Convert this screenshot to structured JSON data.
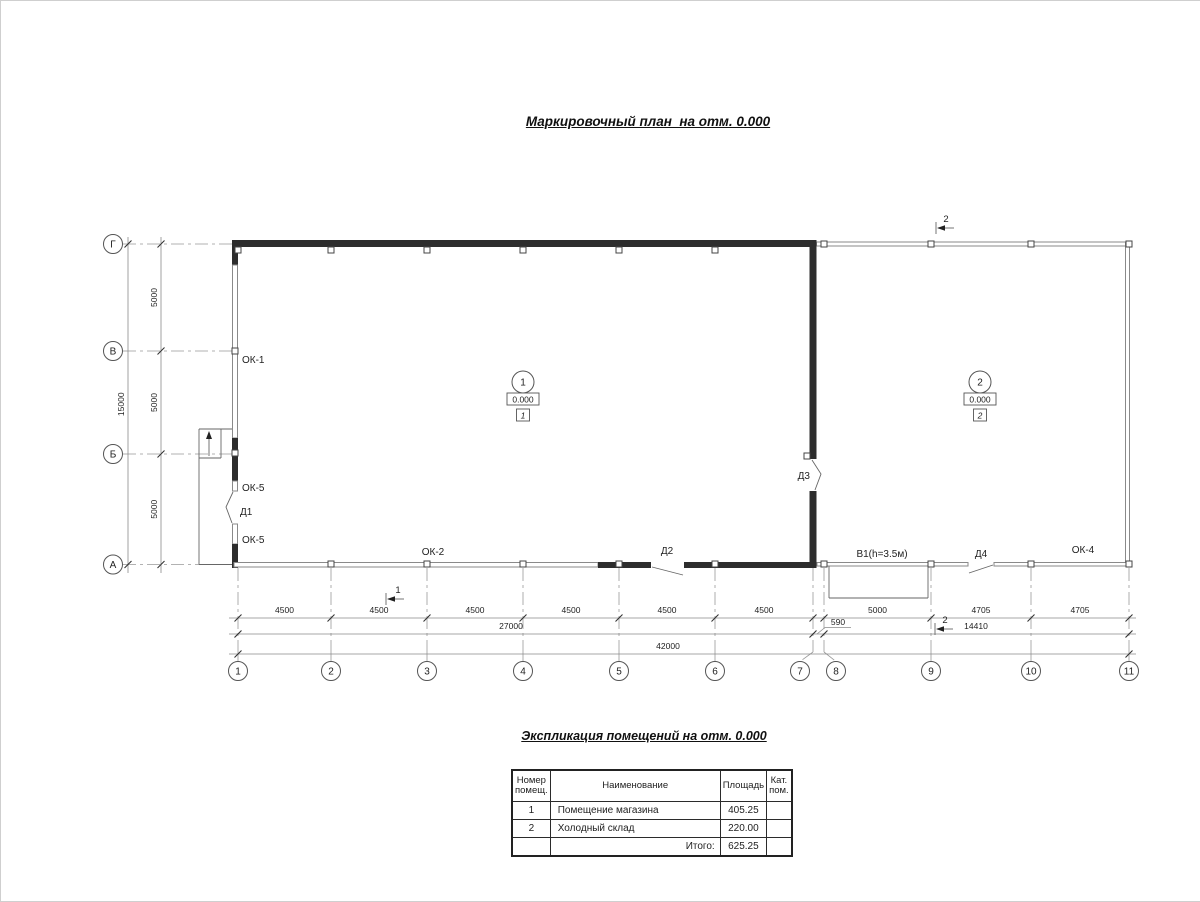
{
  "drawing": {
    "title": "Маркировочный план  на отм. 0.000",
    "col_axes": [
      {
        "label": "1",
        "x": 237,
        "cx": 237
      },
      {
        "label": "2",
        "x": 330,
        "cx": 330
      },
      {
        "label": "3",
        "x": 426,
        "cx": 426
      },
      {
        "label": "4",
        "x": 522,
        "cx": 522
      },
      {
        "label": "5",
        "x": 618,
        "cx": 618
      },
      {
        "label": "6",
        "x": 714,
        "cx": 714
      },
      {
        "label": "7",
        "x": 812,
        "cx": 799
      },
      {
        "label": "8",
        "x": 823,
        "cx": 835
      },
      {
        "label": "9",
        "x": 930,
        "cx": 930
      },
      {
        "label": "10",
        "x": 1030,
        "cx": 1030
      },
      {
        "label": "11",
        "x": 1128,
        "cx": 1128
      }
    ],
    "row_axes": [
      {
        "label": "Г",
        "y": 243
      },
      {
        "label": "В",
        "y": 350
      },
      {
        "label": "Б",
        "y": 453
      },
      {
        "label": "А",
        "y": 563.5
      }
    ],
    "h_dims": [
      {
        "v": "4500",
        "x1": 237,
        "x2": 330,
        "y": 617
      },
      {
        "v": "4500",
        "x1": 330,
        "x2": 426,
        "y": 617
      },
      {
        "v": "4500",
        "x1": 426,
        "x2": 522,
        "y": 617
      },
      {
        "v": "4500",
        "x1": 522,
        "x2": 618,
        "y": 617
      },
      {
        "v": "4500",
        "x1": 618,
        "x2": 714,
        "y": 617
      },
      {
        "v": "4500",
        "x1": 714,
        "x2": 812,
        "y": 617
      },
      {
        "v": "5000",
        "x1": 823,
        "x2": 930,
        "y": 617
      },
      {
        "v": "4705",
        "x1": 930,
        "x2": 1030,
        "y": 617
      },
      {
        "v": "4705",
        "x1": 1030,
        "x2": 1128,
        "y": 617
      },
      {
        "v": "27000",
        "x1": 237,
        "x2": 812,
        "y": 633,
        "tx": 510
      },
      {
        "v": "14410",
        "x1": 823,
        "x2": 1128,
        "y": 633,
        "tx": 975
      },
      {
        "v": "42000",
        "x1": 237,
        "x2": 1128,
        "y": 653,
        "tx": 667
      }
    ],
    "dim_590": {
      "v": "590",
      "x": 837,
      "y": 624
    },
    "v_dims": [
      {
        "v": "5000",
        "y1": 243,
        "y2": 350,
        "x": 160
      },
      {
        "v": "5000",
        "y1": 350,
        "y2": 453,
        "x": 160
      },
      {
        "v": "5000",
        "y1": 453,
        "y2": 563.5,
        "x": 160
      },
      {
        "v": "15000",
        "y1": 243,
        "y2": 563.5,
        "x": 127
      }
    ],
    "labels": [
      {
        "id": "ok-1",
        "text": "ОК-1",
        "x": 241,
        "y": 362,
        "a": "s"
      },
      {
        "id": "ok-5-upper",
        "text": "ОК-5",
        "x": 241,
        "y": 490,
        "a": "s"
      },
      {
        "id": "d1",
        "text": "Д1",
        "x": 239,
        "y": 514,
        "a": "s"
      },
      {
        "id": "ok-5-lower",
        "text": "ОК-5",
        "x": 241,
        "y": 542,
        "a": "s"
      },
      {
        "id": "ok-2",
        "text": "ОК-2",
        "x": 432,
        "y": 554,
        "a": "m"
      },
      {
        "id": "d2",
        "text": "Д2",
        "x": 666,
        "y": 553,
        "a": "m"
      },
      {
        "id": "d3",
        "text": "Д3",
        "x": 809,
        "y": 478,
        "a": "e"
      },
      {
        "id": "v1-gate",
        "text": "В1(h=3.5м)",
        "x": 881,
        "y": 556,
        "a": "m"
      },
      {
        "id": "d4",
        "text": "Д4",
        "x": 980,
        "y": 556,
        "a": "m"
      },
      {
        "id": "ok-4",
        "text": "ОК-4",
        "x": 1082,
        "y": 552,
        "a": "m"
      }
    ],
    "rooms": [
      {
        "number": "1",
        "elevation": "0.000",
        "tag": "1",
        "x": 522,
        "y": 381
      },
      {
        "number": "2",
        "elevation": "0.000",
        "tag": "2",
        "x": 979,
        "y": 381
      }
    ],
    "sections": [
      {
        "label": "1",
        "lx": 397,
        "ly": 592,
        "ax1": 403,
        "ax2": 387,
        "ay": 598,
        "tick": 385
      },
      {
        "label": "2",
        "lx": 945,
        "ly": 221,
        "ax1": 953,
        "ax2": 937,
        "ay": 227,
        "tick": 935
      },
      {
        "label": "2",
        "lx": 944,
        "ly": 622,
        "ax1": 952,
        "ax2": 936,
        "ay": 628,
        "tick": 934
      }
    ]
  },
  "explication": {
    "title": "Экспликация помещений на отм. 0.000",
    "headers": {
      "num": "Номер помещ.",
      "name": "Наименование",
      "area": "Площадь",
      "cat": "Кат. пом."
    },
    "rows": [
      {
        "num": "1",
        "name": "Помещение магазина",
        "area": "405.25",
        "cat": ""
      },
      {
        "num": "2",
        "name": "Холодный склад",
        "area": "220.00",
        "cat": ""
      }
    ],
    "total_label": "Итого:",
    "total": "625.25"
  }
}
